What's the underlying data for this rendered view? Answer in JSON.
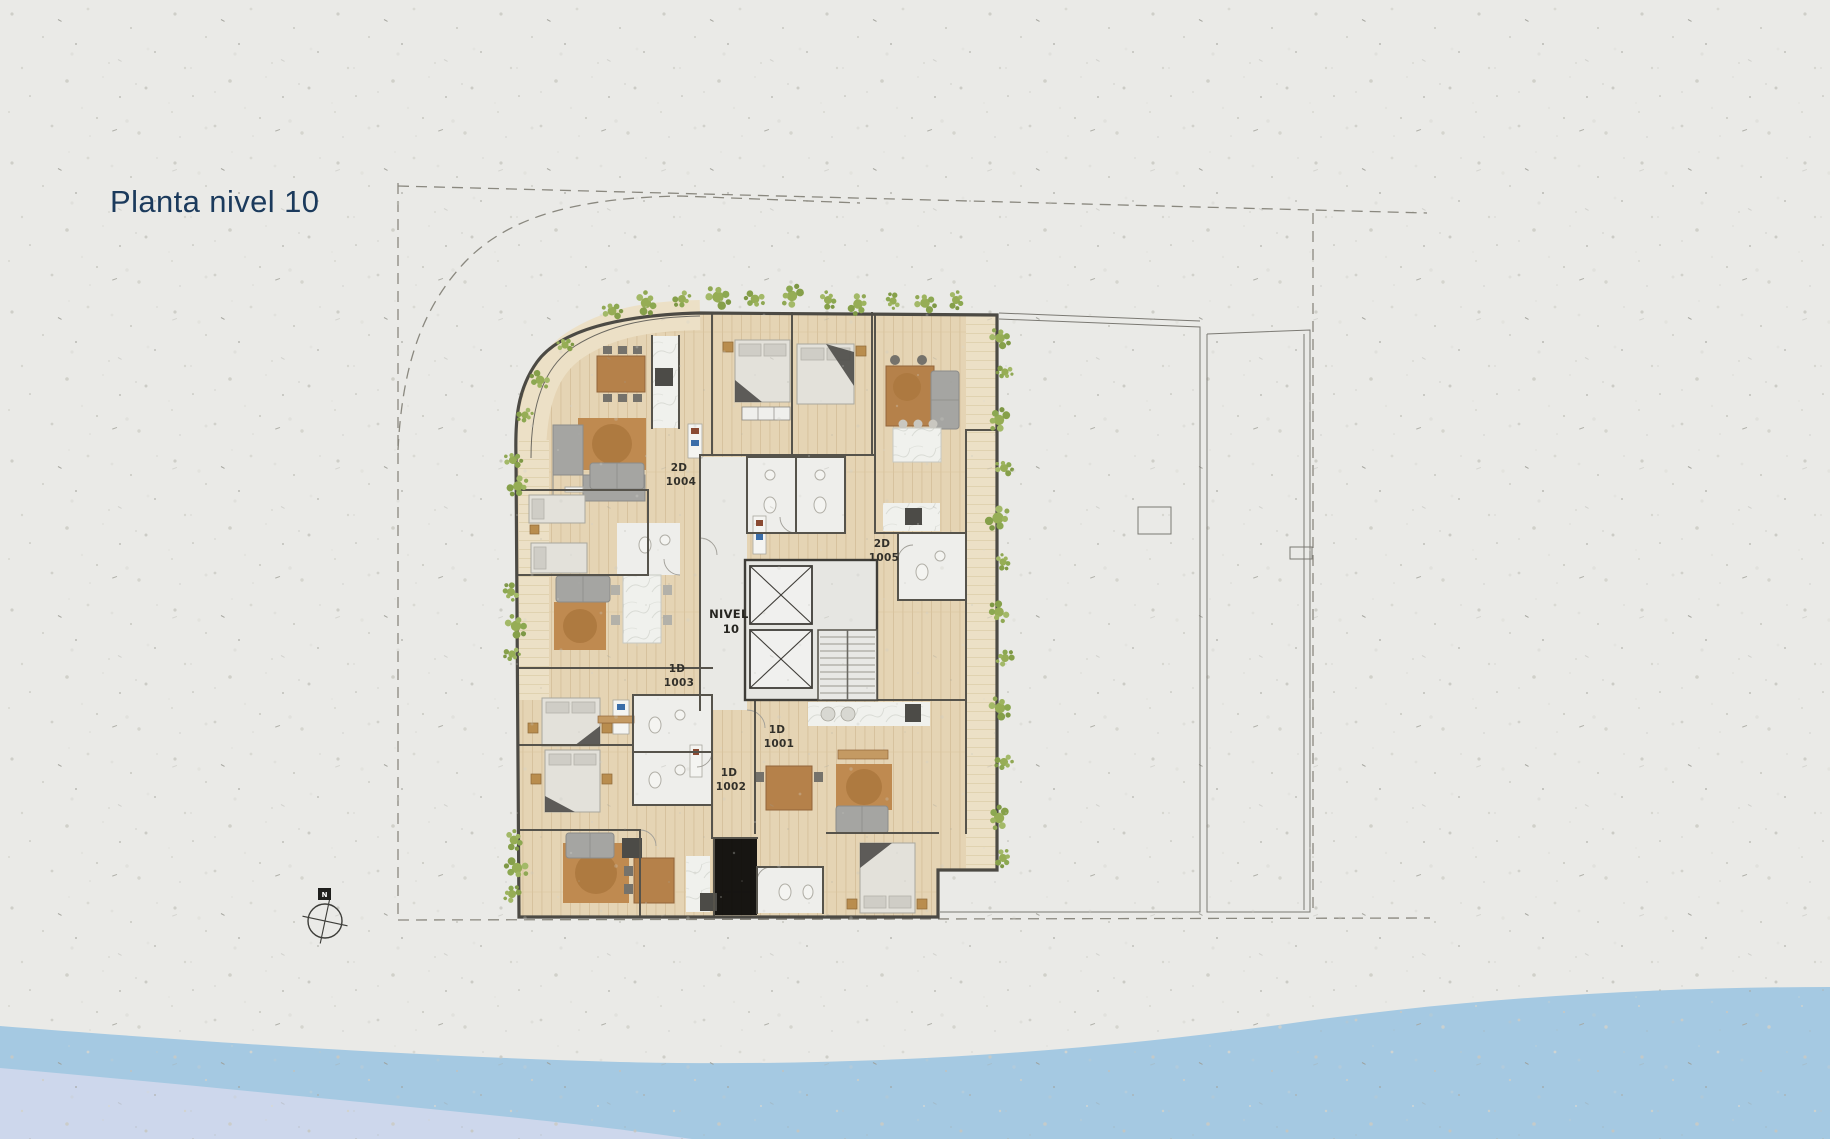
{
  "page": {
    "title": "Planta nivel 10",
    "background_texture": "speckled paper"
  },
  "plan": {
    "level_label": {
      "line1": "NIVEL",
      "line2": "10"
    },
    "units": [
      {
        "type": "2D",
        "number": "1004"
      },
      {
        "type": "2D",
        "number": "1005"
      },
      {
        "type": "1D",
        "number": "1003"
      },
      {
        "type": "1D",
        "number": "1001"
      },
      {
        "type": "1D",
        "number": "1002"
      }
    ],
    "compass_marker": "N"
  },
  "colors": {
    "title_text": "#1b3a5c",
    "paper": "#eaeae7",
    "water_main": "#a5c9e2",
    "water_light": "#cdd7ec",
    "wood_floor": "#e5d4b4",
    "balcony_wood": "#ece0c6",
    "vine_green": "#93ac52",
    "wall_line": "#56534b",
    "rug_brown": "#bf8a50",
    "sofa_gray": "#a5a5a2"
  }
}
